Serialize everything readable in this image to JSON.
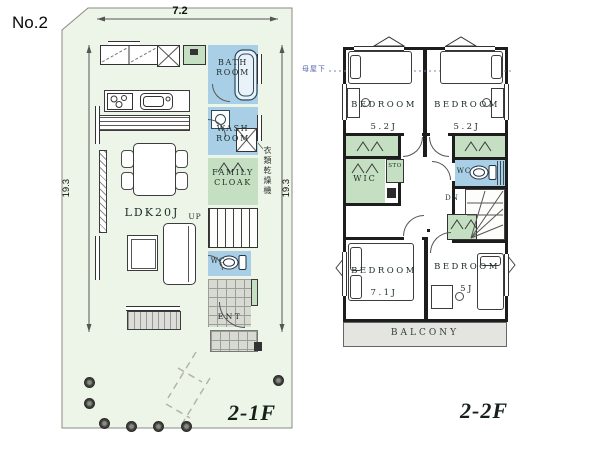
{
  "title": {
    "plan_no": "No.2"
  },
  "dimensions": {
    "site_width": "7.2",
    "site_depth_left": "19.3",
    "site_depth_right": "19.3"
  },
  "floor1": {
    "floor_label": "2-1F",
    "rooms": {
      "bath": "BATH\nROOM",
      "wash": "WASH\nROOM",
      "family_cloak": "FAMILY\nCLOAK",
      "ldk": "LDK20J",
      "wc": "WC",
      "entrance": "ENT"
    },
    "stairs_up": "UP",
    "note_dryer": "衣類乾燥機"
  },
  "floor2": {
    "floor_label": "2-2F",
    "note_eave": "母屋下",
    "rooms": {
      "bedroom_tl": {
        "name": "BEDROOM",
        "size": "5.2J"
      },
      "bedroom_tr": {
        "name": "BEDROOM",
        "size": "5.2J"
      },
      "bedroom_bl": {
        "name": "BEDROOM",
        "size": "7.1J"
      },
      "bedroom_br": {
        "name": "BEDROOM",
        "size": "5J"
      },
      "wic": "WIC",
      "storage": "STO",
      "wc": "WC",
      "balcony": "BALCONY"
    },
    "stairs_down": "DN"
  },
  "colors": {
    "site_fill": "#edf5e8",
    "wet_room_fill": "#a9cfe7",
    "closet_fill": "#c5dfc2",
    "wall": "#1d1d1d",
    "balcony_fill": "#e4e4e0",
    "floor_label_color": "#152019",
    "eave_note_color": "#5566aa"
  }
}
